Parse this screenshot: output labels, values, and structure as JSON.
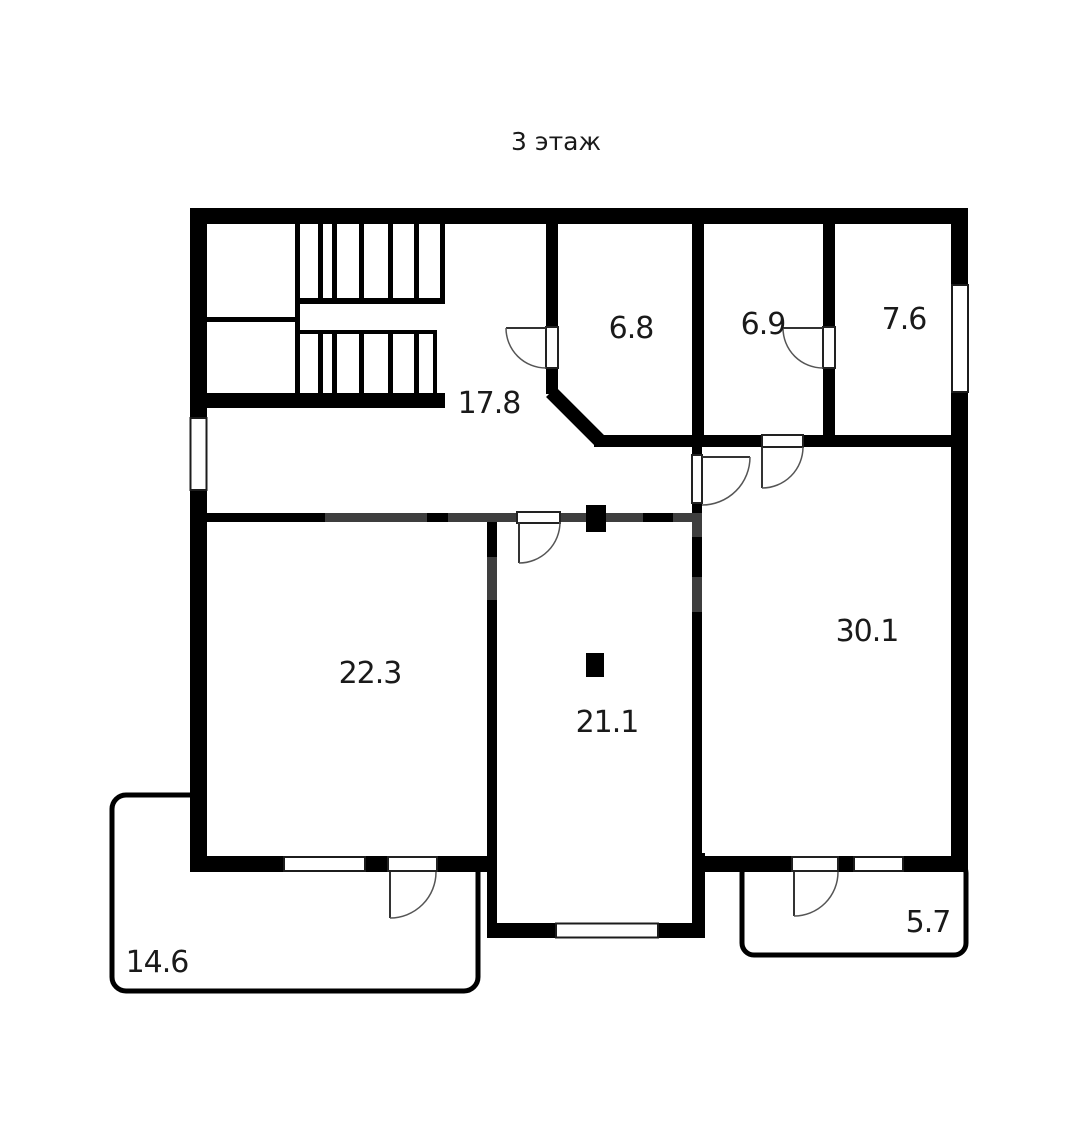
{
  "title": {
    "text": "3 этаж"
  },
  "colors": {
    "wall": "#000000",
    "wall_faded": "#3e3e3e",
    "label": "#1a1a1a"
  },
  "rooms": [
    {
      "id": "hall",
      "kind": "hallway",
      "area": "17.8"
    },
    {
      "id": "room-6-8",
      "kind": "room",
      "area": "6.8"
    },
    {
      "id": "room-6-9",
      "kind": "room",
      "area": "6.9"
    },
    {
      "id": "room-7-6",
      "kind": "room",
      "area": "7.6"
    },
    {
      "id": "room-22-3",
      "kind": "room",
      "area": "22.3"
    },
    {
      "id": "room-21-1",
      "kind": "room",
      "area": "21.1"
    },
    {
      "id": "room-30-1",
      "kind": "room",
      "area": "30.1"
    },
    {
      "id": "balcony-14-6",
      "kind": "balcony",
      "area": "14.6"
    },
    {
      "id": "balcony-5-7",
      "kind": "balcony",
      "area": "5.7"
    }
  ]
}
